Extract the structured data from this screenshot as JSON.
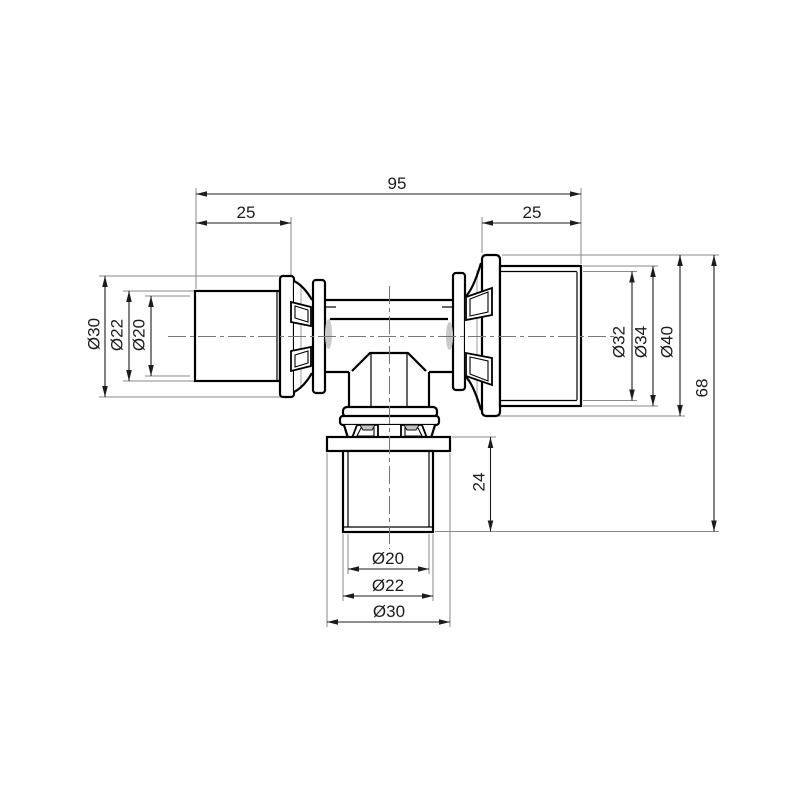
{
  "drawing": {
    "type": "technical-dimension-drawing",
    "subject": "press tee reducing fitting, front view",
    "dimensions": {
      "overall_length": "95",
      "left_pipe_depth": "25",
      "right_pipe_depth": "25",
      "left_collar_diameter": "Ø30",
      "left_sleeve_diameter": "Ø22",
      "left_bore_diameter": "Ø20",
      "right_bore_diameter": "Ø32",
      "right_sleeve_diameter": "Ø34",
      "right_collar_diameter": "Ø40",
      "overall_height": "68",
      "branch_pipe_depth": "24",
      "branch_bore_diameter": "Ø20",
      "branch_pipe_diameter": "Ø22",
      "branch_collar_diameter": "Ø30"
    },
    "colors": {
      "background": "#ffffff",
      "outline": "#000000",
      "dimension_line": "#1c1c1c",
      "extension_line": "#8a8a8a",
      "centerline": "#777777",
      "bore_shading": "#c9c9c9"
    }
  }
}
